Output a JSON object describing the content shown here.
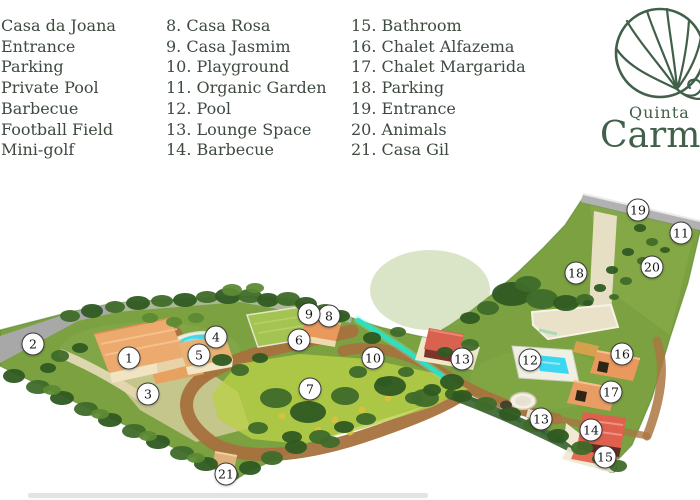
{
  "legend": {
    "text_color": "#3e4a40",
    "columns": [
      {
        "items": [
          "Casa da Joana",
          "Entrance",
          "Parking",
          "Private Pool",
          "Barbecue",
          "Football Field",
          "Mini-golf"
        ]
      },
      {
        "items": [
          "8. Casa Rosa",
          "9. Casa Jasmim",
          "10. Playground",
          "11. Organic Garden",
          "12. Pool",
          "13. Lounge Space",
          "14. Barbecue"
        ]
      },
      {
        "items": [
          "15. Bathroom",
          "16. Chalet Alfazema",
          "17. Chalet Margarida",
          "18. Parking",
          "19. Entrance",
          "20. Animals",
          "21. Casa Gil"
        ]
      }
    ]
  },
  "logo": {
    "line1": "Quinta",
    "line2": "Carm",
    "color": "#41604a",
    "emblem": "fan-leaf"
  },
  "map": {
    "colors": {
      "grass": "#7ba140",
      "dirt_road": "#a7713e",
      "asphalt_road": "#a8a8a8",
      "path_cream": "#e7dfc4",
      "pool_water": "#3bd6f0",
      "stream": "#2ce0c2",
      "roof_orange": "#ecaa6e",
      "roof_red": "#d96150"
    },
    "markers": [
      {
        "n": "1",
        "x": 129,
        "y": 358,
        "label": "Casa da Joana"
      },
      {
        "n": "2",
        "x": 33,
        "y": 344,
        "label": "Entrance"
      },
      {
        "n": "3",
        "x": 148,
        "y": 394,
        "label": "Parking"
      },
      {
        "n": "4",
        "x": 216,
        "y": 337,
        "label": "Private Pool"
      },
      {
        "n": "5",
        "x": 199,
        "y": 355,
        "label": "Barbecue"
      },
      {
        "n": "6",
        "x": 299,
        "y": 340,
        "label": "Football Field"
      },
      {
        "n": "7",
        "x": 310,
        "y": 389,
        "label": "Mini-golf"
      },
      {
        "n": "8",
        "x": 329,
        "y": 316,
        "label": "Casa Rosa"
      },
      {
        "n": "9",
        "x": 309,
        "y": 314,
        "label": "Casa Jasmim"
      },
      {
        "n": "10",
        "x": 373,
        "y": 358,
        "label": "Playground"
      },
      {
        "n": "11",
        "x": 681,
        "y": 233,
        "label": "Organic Garden"
      },
      {
        "n": "12",
        "x": 530,
        "y": 360,
        "label": "Pool"
      },
      {
        "n": "13",
        "x": 462,
        "y": 359,
        "label": "Lounge Space"
      },
      {
        "n": "13",
        "x": 541,
        "y": 419,
        "label": "Lounge Space"
      },
      {
        "n": "14",
        "x": 591,
        "y": 430,
        "label": "Barbecue"
      },
      {
        "n": "15",
        "x": 605,
        "y": 457,
        "label": "Bathroom"
      },
      {
        "n": "16",
        "x": 622,
        "y": 354,
        "label": "Chalet Alfazema"
      },
      {
        "n": "17",
        "x": 611,
        "y": 392,
        "label": "Chalet Margarida"
      },
      {
        "n": "18",
        "x": 576,
        "y": 273,
        "label": "Parking"
      },
      {
        "n": "19",
        "x": 638,
        "y": 210,
        "label": "Entrance"
      },
      {
        "n": "20",
        "x": 652,
        "y": 267,
        "label": "Animals"
      },
      {
        "n": "21",
        "x": 226,
        "y": 474,
        "label": "Casa Gil"
      }
    ]
  }
}
